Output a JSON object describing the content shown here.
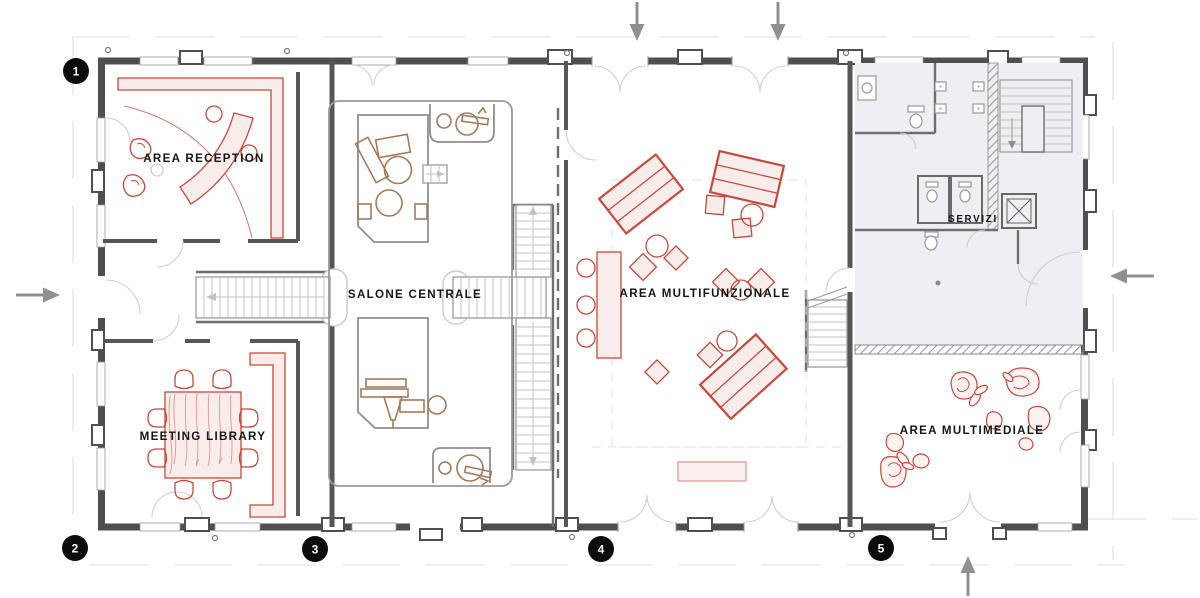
{
  "colors": {
    "wall": "#4f4f4f",
    "accent_red": "#c5493c",
    "accent_red_fill": "#f9edeb",
    "furniture_brown": "#a57a5b",
    "servizi_fill": "#edeff2",
    "marker_bg": "#0c0c0c",
    "marker_text": "#ffffff",
    "arrow_gray": "#8f8f8f",
    "label_text": "#161616"
  },
  "rooms": [
    {
      "id": "area-reception",
      "label": "AREA RECEPTION"
    },
    {
      "id": "salone-centrale",
      "label": "SALONE CENTRALE"
    },
    {
      "id": "area-multifunzionale",
      "label": "AREA MULTIFUNZIONALE"
    },
    {
      "id": "meeting-library",
      "label": "MEETING LIBRARY"
    },
    {
      "id": "servizi",
      "label": "SERVIZI"
    },
    {
      "id": "area-multimediale",
      "label": "AREA MULTIMEDIALE"
    }
  ],
  "markers": [
    {
      "number": "1",
      "position": "top-left"
    },
    {
      "number": "2",
      "position": "bottom-left"
    },
    {
      "number": "3",
      "position": "bottom-center-left"
    },
    {
      "number": "4",
      "position": "bottom-center"
    },
    {
      "number": "5",
      "position": "bottom-center-right"
    }
  ],
  "arrows": [
    {
      "id": "entrance-arrow-top-left",
      "direction": "down"
    },
    {
      "id": "entrance-arrow-top-right",
      "direction": "down"
    },
    {
      "id": "entrance-arrow-left",
      "direction": "right"
    },
    {
      "id": "entrance-arrow-right",
      "direction": "left"
    },
    {
      "id": "entrance-arrow-bottom",
      "direction": "up"
    }
  ]
}
